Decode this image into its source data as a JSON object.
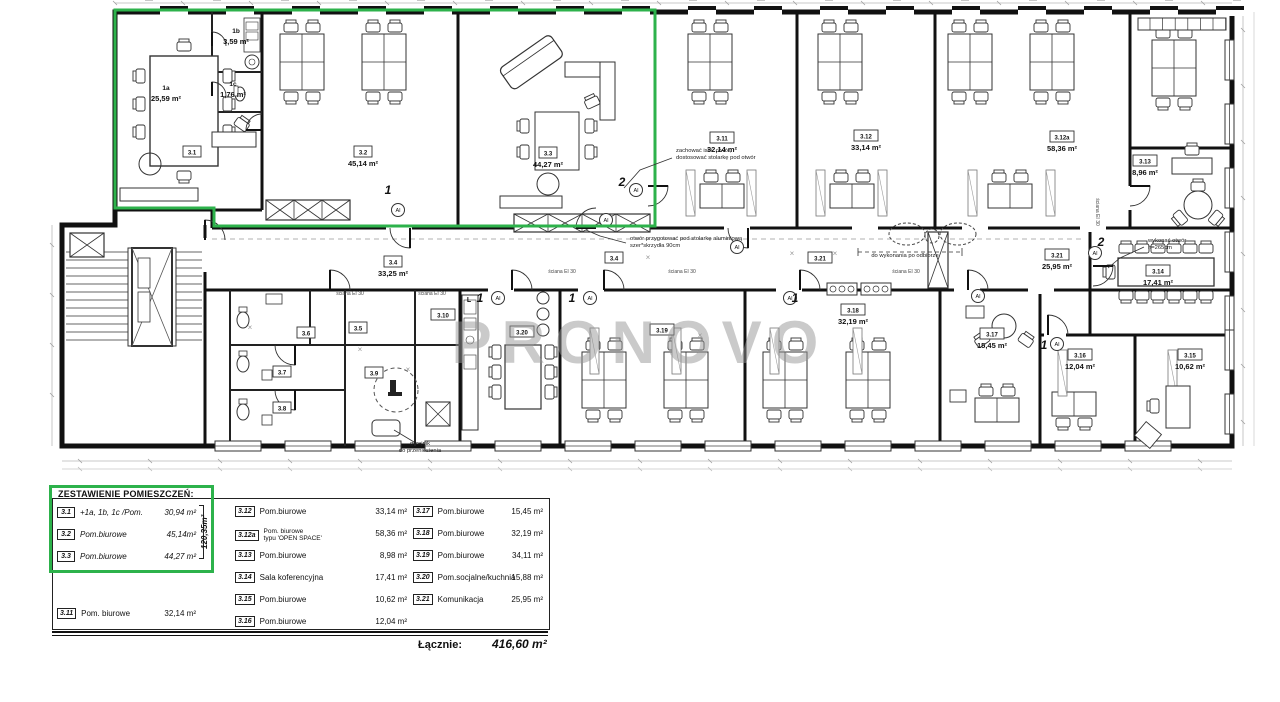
{
  "watermark": {
    "text": "PRONOVO",
    "color": "#9a9a9a"
  },
  "plan": {
    "green": "#2db24b",
    "door_badge": "Al",
    "kitchen_mark": {
      "t": "L",
      "x": 469,
      "y": 302
    },
    "rooms": [
      {
        "n": "1a",
        "a": "25,59 m²",
        "x": 166,
        "y": 90,
        "box": false
      },
      {
        "n": "1b",
        "a": "3,59 m²",
        "x": 236,
        "y": 33,
        "box": false
      },
      {
        "n": "1c",
        "a": "1,76 m²",
        "x": 233,
        "y": 86,
        "box": false
      },
      {
        "n": "3.1",
        "x": 192,
        "y": 152,
        "box": true
      },
      {
        "n": "3.2",
        "a": "45,14 m²",
        "x": 363,
        "y": 152,
        "box": true
      },
      {
        "n": "3.3",
        "a": "44,27 m²",
        "x": 548,
        "y": 153,
        "box": true
      },
      {
        "n": "3.11",
        "a": "32,14 m²",
        "x": 722,
        "y": 138,
        "box": true
      },
      {
        "n": "3.12",
        "a": "33,14 m²",
        "x": 866,
        "y": 136,
        "box": true
      },
      {
        "n": "3.12a",
        "a": "58,36 m²",
        "x": 1062,
        "y": 137,
        "box": true
      },
      {
        "n": "3.13",
        "a": "8,96 m²",
        "x": 1145,
        "y": 161,
        "box": true
      },
      {
        "n": "3.4",
        "a": "33,25 m²",
        "x": 393,
        "y": 262,
        "box": true
      },
      {
        "n": "3.4",
        "x": 614,
        "y": 258,
        "box": true
      },
      {
        "n": "3.21",
        "x": 820,
        "y": 258,
        "box": true
      },
      {
        "n": "3.21",
        "a": "25,95 m²",
        "x": 1057,
        "y": 255,
        "box": true
      },
      {
        "n": "3.5",
        "x": 358,
        "y": 328,
        "box": true
      },
      {
        "n": "3.6",
        "x": 306,
        "y": 333,
        "box": true
      },
      {
        "n": "3.7",
        "x": 282,
        "y": 372,
        "box": true
      },
      {
        "n": "3.8",
        "x": 282,
        "y": 408,
        "box": true
      },
      {
        "n": "3.9",
        "x": 374,
        "y": 373,
        "box": true
      },
      {
        "n": "3.10",
        "x": 443,
        "y": 315,
        "box": true
      },
      {
        "n": "3.20",
        "x": 522,
        "y": 332,
        "box": true
      },
      {
        "n": "3.19",
        "x": 662,
        "y": 330,
        "box": true
      },
      {
        "n": "3.18",
        "a": "32,19 m²",
        "x": 853,
        "y": 310,
        "box": true
      },
      {
        "n": "3.17",
        "a": "15,45 m²",
        "x": 992,
        "y": 334,
        "box": true
      },
      {
        "n": "3.16",
        "a": "12,04 m²",
        "x": 1080,
        "y": 355,
        "box": true
      },
      {
        "n": "3.15",
        "a": "10,62 m²",
        "x": 1190,
        "y": 355,
        "box": true
      },
      {
        "n": "3.14",
        "a": "17,41 m²",
        "x": 1158,
        "y": 271,
        "box": true
      }
    ],
    "numbers": [
      {
        "t": "1",
        "x": 388,
        "y": 194
      },
      {
        "t": "2",
        "x": 622,
        "y": 186
      },
      {
        "t": "1",
        "x": 480,
        "y": 302
      },
      {
        "t": "1",
        "x": 572,
        "y": 302
      },
      {
        "t": "1",
        "x": 795,
        "y": 302
      },
      {
        "t": "1",
        "x": 1044,
        "y": 349
      },
      {
        "t": "2",
        "x": 1101,
        "y": 246
      }
    ],
    "annotations": [
      {
        "lines": [
          "zachować istn. otwór,",
          "dostosować stolarkę pod otwór"
        ],
        "x": 676,
        "y": 152,
        "anchor": "start",
        "leader": [
          [
            672,
            158
          ],
          [
            640,
            170
          ],
          [
            624,
            188
          ]
        ]
      },
      {
        "lines": [
          "otwór przygotować pod stolarkę aluminiową",
          "szer*skrzydła 90cm"
        ],
        "x": 630,
        "y": 240,
        "anchor": "start",
        "leader": [
          [
            626,
            243
          ],
          [
            600,
            236
          ],
          [
            586,
            230
          ]
        ]
      },
      {
        "lines": [
          "do wykonania po odbiorze"
        ],
        "x": 905,
        "y": 257,
        "anchor": "middle",
        "bracket": [
          858,
          252,
          962
        ]
      },
      {
        "lines": [
          "wykonać otwór",
          "h=265cm"
        ],
        "x": 1148,
        "y": 242,
        "anchor": "start",
        "leader": [
          [
            1144,
            247
          ],
          [
            1120,
            258
          ],
          [
            1108,
            268
          ]
        ]
      },
      {
        "lines": [
          "grzejnik",
          "do przeniesienia"
        ],
        "x": 420,
        "y": 445,
        "anchor": "middle",
        "leader": [
          [
            414,
            442
          ],
          [
            394,
            430
          ]
        ]
      }
    ],
    "wall_tags": [
      {
        "t": "ściana EI 30",
        "x": 350,
        "y": 295
      },
      {
        "t": "ściana EI 30",
        "x": 432,
        "y": 295
      },
      {
        "t": "ściana EI 30",
        "x": 562,
        "y": 273
      },
      {
        "t": "ściana EI 30",
        "x": 682,
        "y": 273
      },
      {
        "t": "ściana EI 30",
        "x": 906,
        "y": 273
      },
      {
        "t": "ściana EI 30",
        "x": 1096,
        "y": 212,
        "rot": 90
      }
    ]
  },
  "legend": {
    "title": "ZESTAWIENIE POMIESZCZEŃ:",
    "groupA": [
      {
        "no": "3.1",
        "name": "+1a, 1b, 1c /Pom.",
        "area": "30,94 m²"
      },
      {
        "no": "3.2",
        "name": "Pom.biurowe",
        "area": "45,14m²"
      },
      {
        "no": "3.3",
        "name": "Pom.biurowe",
        "area": "44,27 m²"
      }
    ],
    "group_total": "120,35m²",
    "rowA2": {
      "no": "3.11",
      "name": "Pom. biurowe",
      "area": "32,14 m²"
    },
    "colB": [
      {
        "no": "3.12",
        "name": "Pom.biurowe",
        "area": "33,14 m²"
      },
      {
        "no": "3.12a",
        "name": "Pom. biurowe",
        "name2": "typu 'OPEN SPACE'",
        "area": "58,36 m²"
      },
      {
        "no": "3.13",
        "name": "Pom.biurowe",
        "area": "8,98 m²"
      },
      {
        "no": "3.14",
        "name": "Sala koferencyjna",
        "area": "17,41 m²"
      },
      {
        "no": "3.15",
        "name": "Pom.biurowe",
        "area": "10,62 m²"
      },
      {
        "no": "3.16",
        "name": "Pom.biurowe",
        "area": "12,04 m²"
      }
    ],
    "colC": [
      {
        "no": "3.17",
        "name": "Pom.biurowe",
        "area": "15,45 m²"
      },
      {
        "no": "3.18",
        "name": "Pom.biurowe",
        "area": "32,19 m²"
      },
      {
        "no": "3.19",
        "name": "Pom.biurowe",
        "area": "34,11 m²"
      },
      {
        "no": "3.20",
        "name": "Pom.socjalne/kuchnia",
        "area": "15,88 m²"
      },
      {
        "no": "3.21",
        "name": "Komunikacja",
        "area": "25,95 m²"
      }
    ],
    "total_label": "Łącznie:",
    "total_value": "416,60 m²"
  }
}
